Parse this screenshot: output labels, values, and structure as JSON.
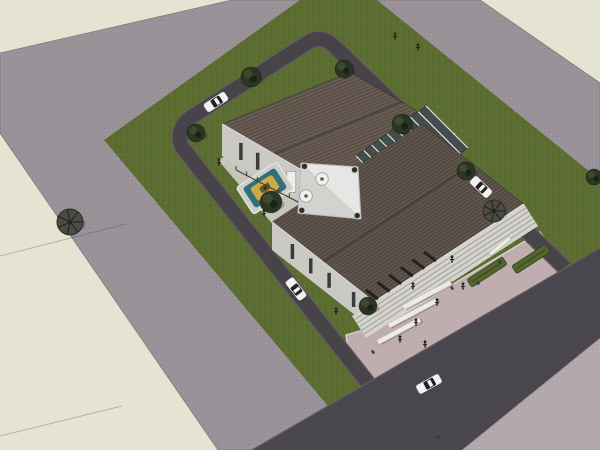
{
  "scene": {
    "kind": "3d-architectural-site-render",
    "style": "sketchup-aerial-axonometric",
    "width": 600,
    "height": 450
  },
  "colors": {
    "bg": "#e5e3d2",
    "outer_road": "#9a9299",
    "outer_road_edge": "#7f7a76",
    "grass": "#5c6d31",
    "courtyard": "#c8c6b8",
    "plaza": "#c0adaf",
    "plaza_curb": "#d9d4cf",
    "loop_road": "#474349",
    "loop_curb": "#605c62",
    "boulevard": "#4a464d",
    "pavement": "#b3a9aa",
    "roof_north_base": "#695d54",
    "roof_north_seam": "#544a42",
    "roof_south_base": "#60564e",
    "roof_south_seam": "#4c433c",
    "eave_light": "#eceae6",
    "wall": "#cbc9c5",
    "wall_shade": "#b7b5b0",
    "window_dark": "#383d39",
    "door_white": "#efede9",
    "atrium_glass": "#434d4b",
    "mullion": "#e9e9e5",
    "stairs": "#d5d3ce",
    "stair_line": "#a29f9a",
    "louver": "#24211e",
    "canopy_light": "#e6e6e4",
    "canopy_shade": "#d2d2cf",
    "canopy_node": "#2e2e2e",
    "pool_pale": "#c9cfc4",
    "pool_teal": "#346e79",
    "pool_gold": "#c9ac47",
    "pool_core": "#6b5a2a",
    "hedge": "#55662f",
    "bench": "#ecebe7",
    "tree_round": "#2a3522",
    "tree_round_light": "#42502f",
    "tree_flat": "#4a4b43",
    "car_body": "#f2f2f0",
    "car_glass": "#202024",
    "person": "#26261f"
  },
  "ground": {
    "outer_road": [
      [
        232,
        0
      ],
      [
        480,
        0
      ],
      [
        600,
        83
      ],
      [
        600,
        450
      ],
      [
        218,
        450
      ],
      [
        0,
        133
      ],
      [
        0,
        53
      ]
    ],
    "grass": [
      [
        300,
        0
      ],
      [
        377,
        0
      ],
      [
        600,
        180
      ],
      [
        600,
        300
      ],
      [
        365,
        450
      ],
      [
        104,
        140
      ]
    ],
    "courtyard": [
      [
        218,
        160
      ],
      [
        345,
        95
      ],
      [
        430,
        200
      ],
      [
        310,
        268
      ]
    ],
    "plaza": [
      [
        540,
        232
      ],
      [
        572,
        274
      ],
      [
        380,
        400
      ],
      [
        350,
        362
      ],
      [
        346,
        335
      ],
      [
        388,
        323
      ]
    ],
    "boulevard": [
      [
        252,
        450
      ],
      [
        600,
        248
      ],
      [
        600,
        338
      ],
      [
        462,
        450
      ]
    ],
    "pavement": [
      [
        600,
        338
      ],
      [
        600,
        450
      ],
      [
        462,
        450
      ]
    ],
    "loop_road_path": "M565,268 L335,47 Q320,33 307,43 L190,118 Q175,130 182,147 L368,383",
    "seams": [
      [
        [
          0,
          256
        ],
        [
          126,
          224
        ]
      ],
      [
        [
          0,
          436
        ],
        [
          122,
          406
        ]
      ]
    ]
  },
  "buildings": {
    "hall_north": {
      "roof": [
        [
          222,
          124
        ],
        [
          350,
          72
        ],
        [
          455,
          133
        ],
        [
          327,
          185
        ]
      ],
      "ridge": [
        [
          274,
          154
        ],
        [
          402,
          102
        ]
      ],
      "wall_sw": [
        [
          222,
          124
        ],
        [
          327,
          185
        ],
        [
          327,
          217
        ],
        [
          222,
          156
        ]
      ],
      "wall_se": [
        [
          327,
          185
        ],
        [
          455,
          133
        ],
        [
          455,
          165
        ],
        [
          327,
          217
        ]
      ],
      "se_band": [
        [
          333,
          196
        ],
        [
          450,
          148
        ],
        [
          450,
          161
        ],
        [
          333,
          209
        ]
      ],
      "windows_sw": [
        0.18,
        0.34,
        0.5,
        0.82
      ],
      "door_sw": 0.66,
      "wall_h": 32
    },
    "hall_south": {
      "roof": [
        [
          272,
          222
        ],
        [
          422,
          124
        ],
        [
          524,
          204
        ],
        [
          374,
          302
        ]
      ],
      "ridge": [
        [
          323,
          262
        ],
        [
          473,
          164
        ]
      ],
      "wall_sw": [
        [
          272,
          222
        ],
        [
          374,
          302
        ],
        [
          374,
          330
        ],
        [
          272,
          250
        ]
      ],
      "windows_sw": [
        0.2,
        0.38,
        0.56,
        0.8
      ],
      "wall_h": 28
    },
    "atrium": {
      "quad": [
        [
          356,
          156
        ],
        [
          426,
          106
        ],
        [
          468,
          148
        ],
        [
          398,
          198
        ]
      ],
      "mullions": 9
    },
    "stairs": {
      "quad": [
        [
          352,
          316
        ],
        [
          524,
          204
        ],
        [
          538,
          226
        ],
        [
          366,
          338
        ]
      ],
      "steps": 6
    },
    "louvers": {
      "from": [
        378,
        299
      ],
      "to": [
        436,
        261
      ],
      "count": 6,
      "dx": -12,
      "dy": -9
    }
  },
  "landscape": {
    "pool": {
      "x": 265,
      "y": 188,
      "rot": -33,
      "rings": [
        [
          48,
          32,
          "pool_pale"
        ],
        [
          38,
          24,
          "pool_teal"
        ],
        [
          26,
          16,
          "pool_gold"
        ],
        [
          11,
          7,
          "pool_core"
        ]
      ]
    },
    "fence": {
      "from": [
        236,
        170
      ],
      "to": [
        300,
        203
      ],
      "posts": 6
    },
    "canopy": {
      "corners": [
        [
          301,
          163
        ],
        [
          358,
          167
        ],
        [
          361,
          219
        ],
        [
          298,
          213
        ]
      ],
      "tables": [
        [
          322,
          179
        ],
        [
          306,
          196
        ]
      ],
      "posts": [
        [
          298,
          213,
          25
        ],
        [
          313,
          218,
          28
        ],
        [
          334,
          222,
          30
        ],
        [
          358,
          219,
          23
        ]
      ]
    },
    "hedges": [
      {
        "x": 531,
        "y": 259,
        "rot": -33,
        "len": 40
      },
      {
        "x": 487,
        "y": 272,
        "rot": -33,
        "len": 42
      }
    ],
    "white_wall": {
      "x": 500,
      "y": 246,
      "rot": -40,
      "len": 26
    },
    "benches": [
      {
        "x": 427,
        "y": 295,
        "rot": -28,
        "len": 54
      },
      {
        "x": 413,
        "y": 313,
        "rot": -28,
        "len": 55
      },
      {
        "x": 399,
        "y": 331,
        "rot": -28,
        "len": 48
      }
    ],
    "trees": [
      {
        "x": 251,
        "y": 77,
        "r": 10,
        "style": "round"
      },
      {
        "x": 344,
        "y": 69,
        "r": 9,
        "style": "round"
      },
      {
        "x": 196,
        "y": 133,
        "r": 9,
        "style": "round"
      },
      {
        "x": 402,
        "y": 124,
        "r": 10,
        "style": "round"
      },
      {
        "x": 466,
        "y": 171,
        "r": 9,
        "style": "round"
      },
      {
        "x": 494,
        "y": 211,
        "r": 11,
        "style": "flat"
      },
      {
        "x": 70,
        "y": 222,
        "r": 13,
        "style": "flat"
      },
      {
        "x": 368,
        "y": 306,
        "r": 9,
        "style": "round"
      },
      {
        "x": 271,
        "y": 202,
        "r": 11,
        "style": "round"
      },
      {
        "x": 594,
        "y": 177,
        "r": 8,
        "style": "round"
      }
    ]
  },
  "traffic": {
    "cars": [
      {
        "x": 216,
        "y": 102,
        "rot": -33,
        "len": 25
      },
      {
        "x": 481,
        "y": 187,
        "rot": 44,
        "len": 24
      },
      {
        "x": 296,
        "y": 289,
        "rot": 52,
        "len": 24
      },
      {
        "x": 429,
        "y": 384,
        "rot": -29,
        "len": 26
      }
    ],
    "people": [
      [
        395,
        37
      ],
      [
        418,
        48
      ],
      [
        219,
        163
      ],
      [
        264,
        214
      ],
      [
        336,
        312
      ],
      [
        452,
        260
      ],
      [
        413,
        287
      ],
      [
        463,
        287
      ],
      [
        437,
        303
      ],
      [
        416,
        323
      ],
      [
        400,
        340
      ],
      [
        425,
        345
      ]
    ],
    "marks": [
      [
        452,
        288
      ],
      [
        478,
        283
      ],
      [
        500,
        262
      ],
      [
        373,
        352
      ],
      [
        438,
        437
      ]
    ]
  }
}
